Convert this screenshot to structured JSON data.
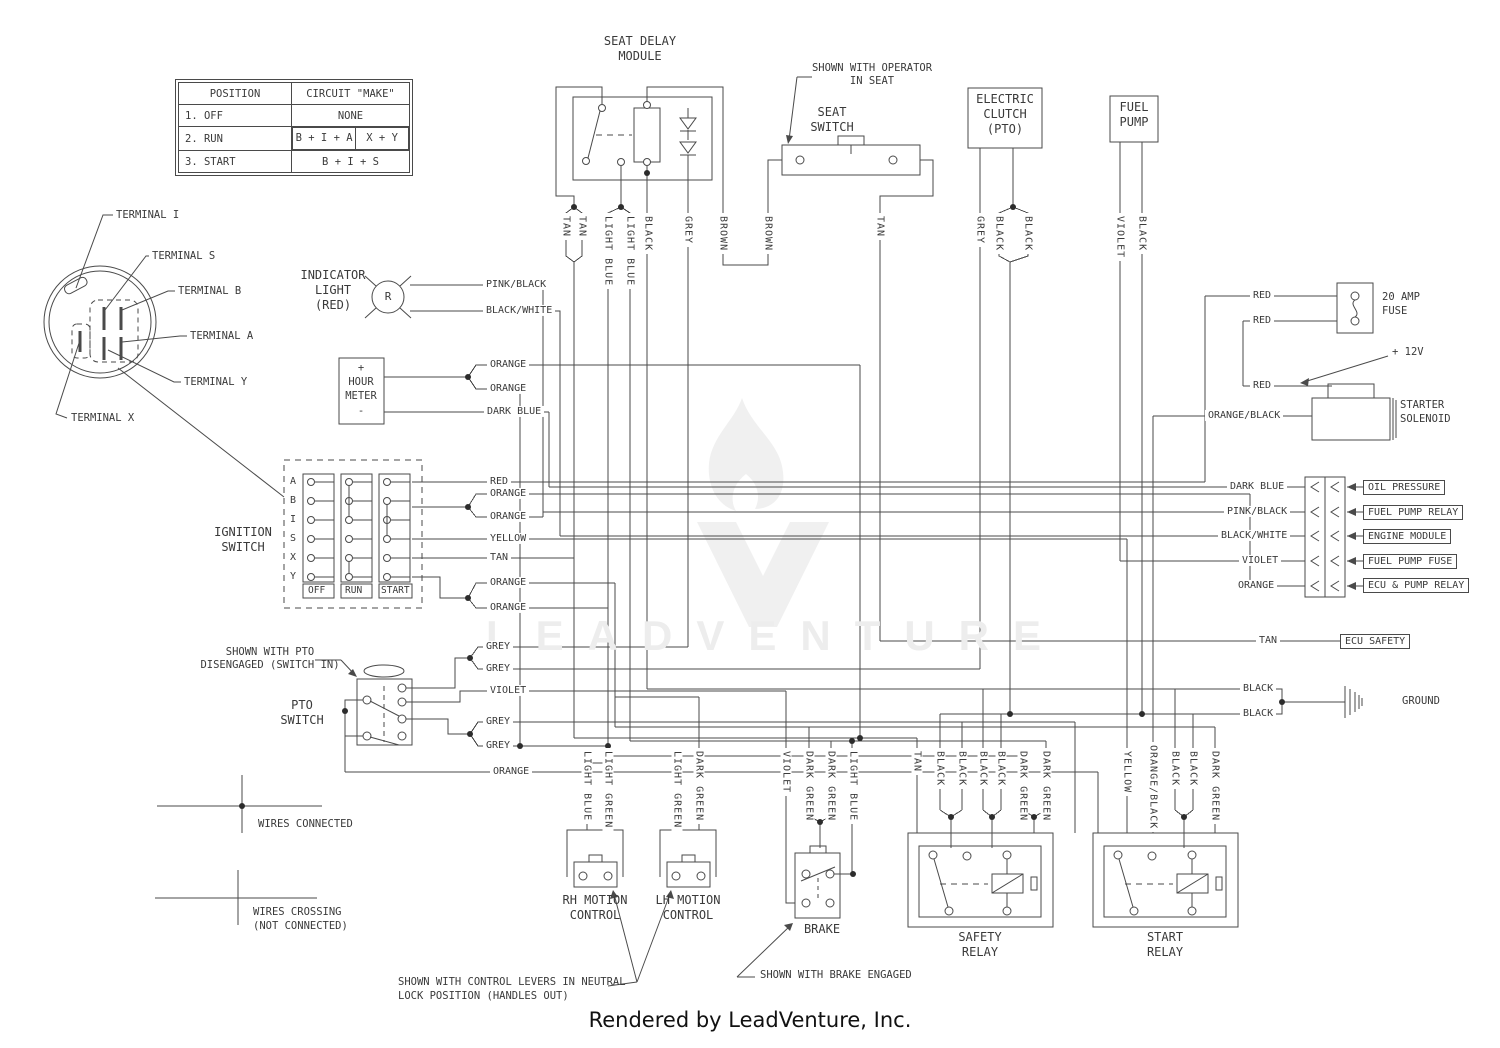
{
  "palette": {
    "line": "#4a4a4a",
    "text": "#3a3a3a",
    "watermark": "#ededed",
    "background": "#ffffff"
  },
  "legend_table": {
    "h1": "POSITION",
    "h2": "CIRCUIT \"MAKE\"",
    "r1c1": "1. OFF",
    "r1c2": "NONE",
    "r2c1": "2. RUN",
    "r2c2a": "B + I + A",
    "r2c2b": "X + Y",
    "r3c1": "3. START",
    "r3c2": "B + I + S"
  },
  "connector": {
    "terminals": [
      "TERMINAL I",
      "TERMINAL S",
      "TERMINAL B",
      "TERMINAL A",
      "TERMINAL Y",
      "TERMINAL X"
    ]
  },
  "components": {
    "seat_delay_module": "SEAT DELAY\nMODULE",
    "seat_switch": "SEAT\nSWITCH",
    "seat_switch_note": "SHOWN WITH OPERATOR\nIN SEAT",
    "electric_clutch": "ELECTRIC\nCLUTCH\n(PTO)",
    "fuel_pump": "FUEL\nPUMP",
    "indicator_light": "INDICATOR\nLIGHT\n(RED)",
    "indicator_symbol": "R",
    "hour_meter": "+\nHOUR\nMETER\n-",
    "ignition_switch": "IGNITION\nSWITCH",
    "pto_switch": "PTO\nSWITCH",
    "pto_note": "SHOWN WITH PTO\nDISENGAGED (SWITCH IN)",
    "fuse": "20 AMP\nFUSE",
    "twelve_v": "+ 12V",
    "starter_solenoid": "STARTER\nSOLENOID",
    "ground": "GROUND",
    "rh_motion": "RH MOTION\nCONTROL",
    "lh_motion": "LH MOTION\nCONTROL",
    "brake": "BRAKE",
    "safety_relay": "SAFETY\nRELAY",
    "start_relay": "START\nRELAY"
  },
  "ignition": {
    "rows": [
      "A",
      "B",
      "I",
      "S",
      "X",
      "Y"
    ],
    "positions": [
      "OFF",
      "RUN",
      "START"
    ]
  },
  "right_connectors": {
    "boxes": [
      "OIL PRESSURE",
      "FUEL PUMP RELAY",
      "ENGINE MODULE",
      "FUEL PUMP FUSE",
      "ECU & PUMP RELAY"
    ],
    "ecu_safety": "ECU SAFETY"
  },
  "wires": {
    "top": [
      "TAN",
      "TAN",
      "LIGHT BLUE",
      "LIGHT BLUE",
      "BLACK",
      "GREY",
      "BROWN",
      "BROWN",
      "TAN",
      "GREY",
      "BLACK",
      "BLACK",
      "VIOLET",
      "BLACK"
    ],
    "bottom": [
      "LIGHT BLUE",
      "LIGHT GREEN",
      "LIGHT GREEN",
      "DARK GREEN",
      "VIOLET",
      "DARK GREEN",
      "DARK GREEN",
      "LIGHT BLUE",
      "TAN",
      "BLACK",
      "BLACK",
      "BLACK",
      "BLACK",
      "DARK GREEN",
      "DARK GREEN",
      "YELLOW",
      "ORANGE/BLACK",
      "BLACK",
      "BLACK",
      "DARK GREEN"
    ],
    "indicator": [
      "PINK/BLACK",
      "BLACK/WHITE"
    ],
    "hour": [
      "ORANGE",
      "ORANGE",
      "DARK BLUE"
    ],
    "ignition": [
      "RED",
      "ORANGE",
      "ORANGE",
      "YELLOW",
      "TAN",
      "ORANGE",
      "ORANGE"
    ],
    "pto": [
      "GREY",
      "GREY",
      "VIOLET",
      "GREY",
      "GREY",
      "ORANGE"
    ],
    "fuse": [
      "RED",
      "RED",
      "RED"
    ],
    "solenoid": "ORANGE/BLACK",
    "block": [
      "DARK BLUE",
      "PINK/BLACK",
      "BLACK/WHITE",
      "VIOLET",
      "ORANGE"
    ],
    "ecu": "TAN",
    "ground": [
      "BLACK",
      "BLACK"
    ]
  },
  "legend": {
    "connected": "WIRES CONNECTED",
    "crossing": "WIRES CROSSING\n(NOT CONNECTED)"
  },
  "captions": {
    "levers": "SHOWN WITH CONTROL LEVERS IN NEUTRAL\nLOCK POSITION (HANDLES OUT)",
    "brake": "SHOWN WITH BRAKE ENGAGED"
  },
  "watermark": "LEADVENTURE",
  "footer": "Rendered by LeadVenture, Inc."
}
